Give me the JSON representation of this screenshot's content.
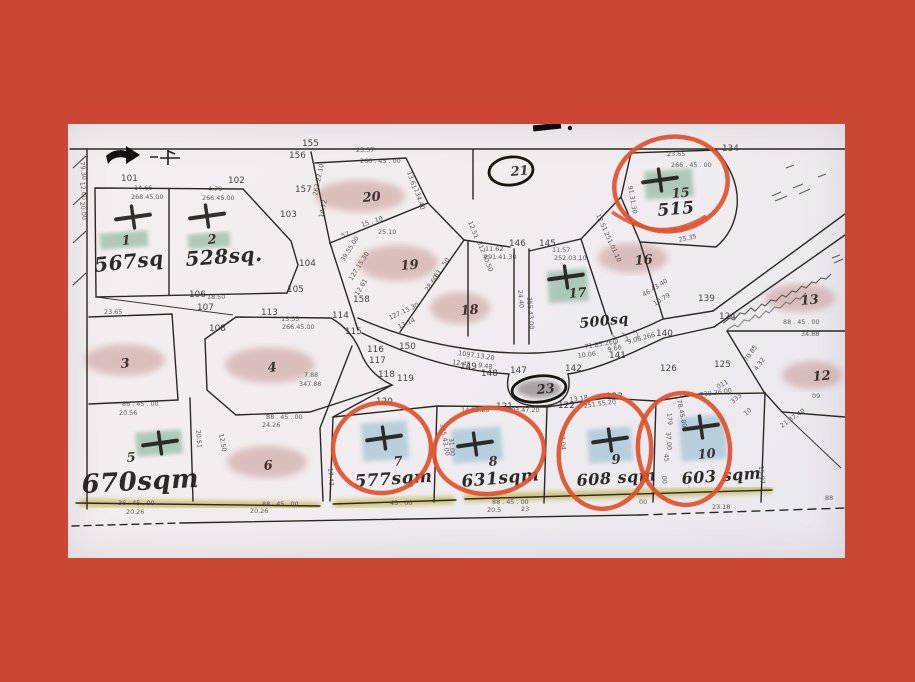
{
  "scene": {
    "description": "photographed cadastral subdivision plat with hand-drawn annotations",
    "border_color": "#cb4733",
    "paper_color": "#f1edef",
    "red_pen_color": "#e0502b",
    "green_highlight_color": "#9dbfae",
    "blue_highlight_color": "#abc8d8",
    "yellow_highlight_color": "#b7a92f",
    "pink_shade_color": "#b5736b"
  },
  "lots": [
    {
      "n": "1",
      "x": 122,
      "y": 245,
      "cross": [
        133,
        217
      ],
      "patch": [
        100,
        232,
        48,
        16,
        "green"
      ],
      "area": {
        "t": "567sq",
        "x": 95,
        "y": 272,
        "s": 20,
        "r": -6
      }
    },
    {
      "n": "2",
      "x": 208,
      "y": 244,
      "cross": [
        207,
        216
      ],
      "patch": [
        188,
        233,
        42,
        15,
        "green"
      ],
      "area": {
        "t": "528sq.",
        "x": 186,
        "y": 266,
        "s": 20,
        "r": -4
      }
    },
    {
      "n": "3",
      "x": 121,
      "y": 368,
      "shade": [
        125,
        360,
        40,
        16
      ]
    },
    {
      "n": "4",
      "x": 268,
      "y": 372,
      "shade": [
        270,
        365,
        45,
        18
      ]
    },
    {
      "n": "5",
      "x": 127,
      "y": 462,
      "cross": [
        160,
        443
      ],
      "patch": [
        136,
        431,
        46,
        24,
        "green"
      ],
      "area": {
        "t": "670sqm",
        "x": 82,
        "y": 493,
        "s": 26,
        "r": -3
      }
    },
    {
      "n": "6",
      "x": 264,
      "y": 470,
      "shade": [
        267,
        462,
        40,
        16
      ]
    },
    {
      "n": "7",
      "x": 394,
      "y": 466,
      "cross": [
        384,
        438
      ],
      "patch": [
        362,
        422,
        46,
        38,
        "blue"
      ],
      "circle": [
        382,
        448,
        49,
        45,
        -5
      ],
      "area": {
        "t": "577sqm",
        "x": 355,
        "y": 487,
        "s": 17,
        "r": -4
      }
    },
    {
      "n": "8",
      "x": 489,
      "y": 466,
      "cross": [
        475,
        444
      ],
      "patch": [
        452,
        428,
        50,
        34,
        "blue"
      ],
      "circle": [
        489,
        451,
        55,
        43,
        -4
      ],
      "area": {
        "t": "631sqm",
        "x": 462,
        "y": 487,
        "s": 17,
        "r": -5
      }
    },
    {
      "n": "9",
      "x": 612,
      "y": 464,
      "cross": [
        610,
        440
      ],
      "patch": [
        588,
        428,
        44,
        34,
        "blue"
      ],
      "circle": [
        605,
        452,
        46,
        57,
        8
      ],
      "area": {
        "t": "608 sqm",
        "x": 577,
        "y": 486,
        "s": 16,
        "r": -4
      }
    },
    {
      "n": "10",
      "x": 698,
      "y": 459,
      "cross": [
        701,
        427
      ],
      "patch": [
        680,
        416,
        46,
        44,
        "blue"
      ],
      "circle": [
        684,
        449,
        46,
        56,
        -6
      ],
      "area": {
        "t": "603 sqm",
        "x": 682,
        "y": 484,
        "s": 16,
        "r": -4
      }
    },
    {
      "n": "12",
      "x": 813,
      "y": 381,
      "shade": [
        812,
        375,
        30,
        14
      ]
    },
    {
      "n": "13",
      "x": 801,
      "y": 305,
      "shade": [
        800,
        298,
        35,
        14
      ]
    },
    {
      "n": "15",
      "x": 672,
      "y": 198,
      "cross": [
        660,
        180
      ],
      "patch": [
        645,
        170,
        48,
        28,
        "green"
      ],
      "circle": [
        671,
        184,
        57,
        47,
        -10
      ],
      "area": {
        "t": "515",
        "x": 658,
        "y": 216,
        "s": 17,
        "r": -5
      }
    },
    {
      "n": "16",
      "x": 635,
      "y": 265,
      "shade": [
        633,
        258,
        35,
        15
      ]
    },
    {
      "n": "17",
      "x": 569,
      "y": 298,
      "cross": [
        566,
        277
      ],
      "patch": [
        548,
        270,
        40,
        32,
        "green"
      ],
      "area": {
        "t": "500sq",
        "x": 580,
        "y": 328,
        "s": 14,
        "r": -6
      }
    },
    {
      "n": "18",
      "x": 461,
      "y": 315,
      "shade": [
        460,
        308,
        30,
        16
      ]
    },
    {
      "n": "19",
      "x": 401,
      "y": 270,
      "shade": [
        398,
        263,
        40,
        18
      ]
    },
    {
      "n": "20",
      "x": 363,
      "y": 202,
      "shade": [
        360,
        196,
        45,
        16
      ]
    },
    {
      "n": "21",
      "x": 511,
      "y": 176,
      "oval": [
        511,
        171,
        22,
        14
      ]
    },
    {
      "n": "23",
      "x": 537,
      "y": 394,
      "oval": [
        539,
        389,
        27,
        13
      ]
    }
  ],
  "points": [
    [
      "101",
      121,
      181
    ],
    [
      "102",
      228,
      183
    ],
    [
      "103",
      280,
      217
    ],
    [
      "104",
      299,
      266
    ],
    [
      "105",
      287,
      292
    ],
    [
      "106",
      189,
      297
    ],
    [
      "107",
      197,
      310
    ],
    [
      "108",
      209,
      331
    ],
    [
      "113",
      261,
      315
    ],
    [
      "114",
      332,
      318
    ],
    [
      "115",
      345,
      334
    ],
    [
      "116",
      367,
      352
    ],
    [
      "117",
      369,
      363
    ],
    [
      "118",
      378,
      377
    ],
    [
      "119",
      397,
      381
    ],
    [
      "120",
      376,
      404
    ],
    [
      "121",
      496,
      409
    ],
    [
      "122",
      558,
      408
    ],
    [
      "123",
      606,
      399
    ],
    [
      "124",
      719,
      319
    ],
    [
      "125",
      714,
      367
    ],
    [
      "126",
      660,
      371
    ],
    [
      "134",
      722,
      151
    ],
    [
      "139",
      698,
      301
    ],
    [
      "140",
      656,
      336
    ],
    [
      "141",
      609,
      358
    ],
    [
      "142",
      565,
      371
    ],
    [
      "145",
      539,
      246
    ],
    [
      "146",
      509,
      246
    ],
    [
      "147",
      510,
      373
    ],
    [
      "148",
      481,
      376
    ],
    [
      "149",
      460,
      369
    ],
    [
      "150",
      399,
      349
    ],
    [
      "155",
      302,
      146
    ],
    [
      "156",
      289,
      158
    ],
    [
      "157",
      295,
      192
    ],
    [
      "158",
      353,
      302
    ]
  ],
  "dims": [
    [
      "23.57",
      356,
      152,
      0
    ],
    [
      "266 . 45 . 00",
      360,
      163,
      0
    ],
    [
      "14.66",
      134,
      190,
      0
    ],
    [
      "268.45.00",
      131,
      199,
      0
    ],
    [
      "4.79",
      208,
      191,
      0
    ],
    [
      "266.45.00",
      202,
      200,
      0
    ],
    [
      "23.65",
      667,
      156,
      0
    ],
    [
      "266 . 45 . 00",
      671,
      167,
      0
    ],
    [
      "91.31.30",
      628,
      186,
      80
    ],
    [
      "25.35",
      670,
      233,
      -12
    ],
    [
      "25.35",
      679,
      242,
      -12
    ],
    [
      "25.10",
      378,
      234,
      0
    ],
    [
      "57",
      342,
      238,
      -18
    ],
    [
      "15 . 10",
      362,
      227,
      -18
    ],
    [
      "13.61",
      407,
      172,
      72
    ],
    [
      "134.40",
      414,
      189,
      72
    ],
    [
      "12.51",
      468,
      222,
      68
    ],
    [
      "312.40.50",
      477,
      242,
      68
    ],
    [
      "11.62",
      485,
      251,
      0
    ],
    [
      "291.41.30",
      484,
      259,
      0
    ],
    [
      "11.57",
      552,
      252,
      0
    ],
    [
      "252.03.10",
      554,
      260,
      0
    ],
    [
      "24.40",
      518,
      290,
      85
    ],
    [
      "355.43.00",
      527,
      297,
      85
    ],
    [
      "61 . 50",
      437,
      278,
      -55
    ],
    [
      "28.60",
      428,
      292,
      -55
    ],
    [
      "12.51",
      596,
      215,
      65
    ],
    [
      "251.01.10",
      604,
      233,
      65
    ],
    [
      "263.22.10",
      317,
      196,
      -78
    ],
    [
      "14.72",
      323,
      218,
      -78
    ],
    [
      "39.55.00",
      344,
      262,
      -58
    ],
    [
      "127.15.30",
      352,
      281,
      -58
    ],
    [
      "12.61",
      358,
      296,
      -58
    ],
    [
      "127.15.30",
      390,
      320,
      -25
    ],
    [
      "13.14",
      399,
      329,
      -25
    ],
    [
      "15.55",
      281,
      321,
      0
    ],
    [
      "266.45.00",
      282,
      329,
      0
    ],
    [
      "23.65",
      104,
      314,
      0
    ],
    [
      "18.50",
      207,
      299,
      0
    ],
    [
      "7.88",
      304,
      377,
      0
    ],
    [
      "347.88",
      299,
      386,
      0
    ],
    [
      "86 . 45 . 00",
      122,
      406,
      0
    ],
    [
      "20.56",
      119,
      415,
      0
    ],
    [
      "88 . 45 . 00",
      266,
      419,
      0
    ],
    [
      "24.26",
      262,
      427,
      0
    ],
    [
      "12.50",
      219,
      434,
      80
    ],
    [
      "1097.13.20",
      458,
      355,
      8
    ],
    [
      "12.45",
      452,
      364,
      8
    ],
    [
      "9.48",
      478,
      367,
      8
    ],
    [
      "71.85.260",
      585,
      349,
      -10
    ],
    [
      "10.06",
      578,
      358,
      -8
    ],
    [
      "9.66",
      608,
      352,
      -12
    ],
    [
      "9.06.266",
      628,
      344,
      -15
    ],
    [
      "46.43.40",
      644,
      297,
      -32
    ],
    [
      "10.79",
      655,
      306,
      -32
    ],
    [
      "178.45.00",
      676,
      396,
      78
    ],
    [
      "88 . 45 . 00",
      783,
      324,
      0
    ],
    [
      "34.88",
      801,
      336,
      0
    ],
    [
      "4.32",
      757,
      371,
      -55
    ],
    [
      "70.85",
      747,
      362,
      -55
    ],
    [
      "21.37.40",
      782,
      428,
      -35
    ],
    [
      "09",
      812,
      398,
      0
    ],
    [
      "230.36.00",
      700,
      397,
      -8
    ],
    [
      "011",
      718,
      389,
      -28
    ],
    [
      "333",
      733,
      404,
      -42
    ],
    [
      "10",
      746,
      416,
      -42
    ],
    [
      "251.55.20",
      584,
      408,
      -8
    ],
    [
      "13.18",
      570,
      402,
      -8
    ],
    [
      "203.47.20",
      507,
      412,
      0
    ],
    [
      "14.83.20",
      461,
      412,
      0
    ],
    [
      "325.43.00",
      440,
      424,
      80
    ],
    [
      "31.00",
      449,
      438,
      85
    ],
    [
      "22.04",
      560,
      432,
      85
    ],
    [
      "179",
      667,
      413,
      85
    ],
    [
      "37.00",
      666,
      432,
      85
    ],
    [
      "45",
      664,
      454,
      85
    ],
    [
      "00",
      662,
      476,
      85
    ],
    [
      "20.51",
      196,
      430,
      85
    ],
    [
      "17.43",
      328,
      468,
      85
    ],
    [
      "15.97",
      759,
      466,
      85
    ],
    [
      "36 . 45 . 00",
      118,
      505,
      0
    ],
    [
      "20.26",
      126,
      514,
      0
    ],
    [
      "45 . 00",
      390,
      505,
      0
    ],
    [
      "88 . 45 . 00",
      492,
      504,
      0
    ],
    [
      "20.5",
      487,
      512,
      0
    ],
    [
      "23",
      521,
      511,
      0
    ],
    [
      "88 . 45 . 00",
      262,
      506,
      0
    ],
    [
      "20.26",
      250,
      513,
      0
    ],
    [
      "23.18",
      712,
      509,
      0
    ],
    [
      "00",
      639,
      504,
      0
    ],
    [
      "88",
      825,
      500,
      0
    ],
    [
      "79.30",
      80,
      162,
      82
    ],
    [
      "12.00",
      80,
      182,
      82
    ],
    [
      "20.00",
      80,
      202,
      82
    ]
  ]
}
